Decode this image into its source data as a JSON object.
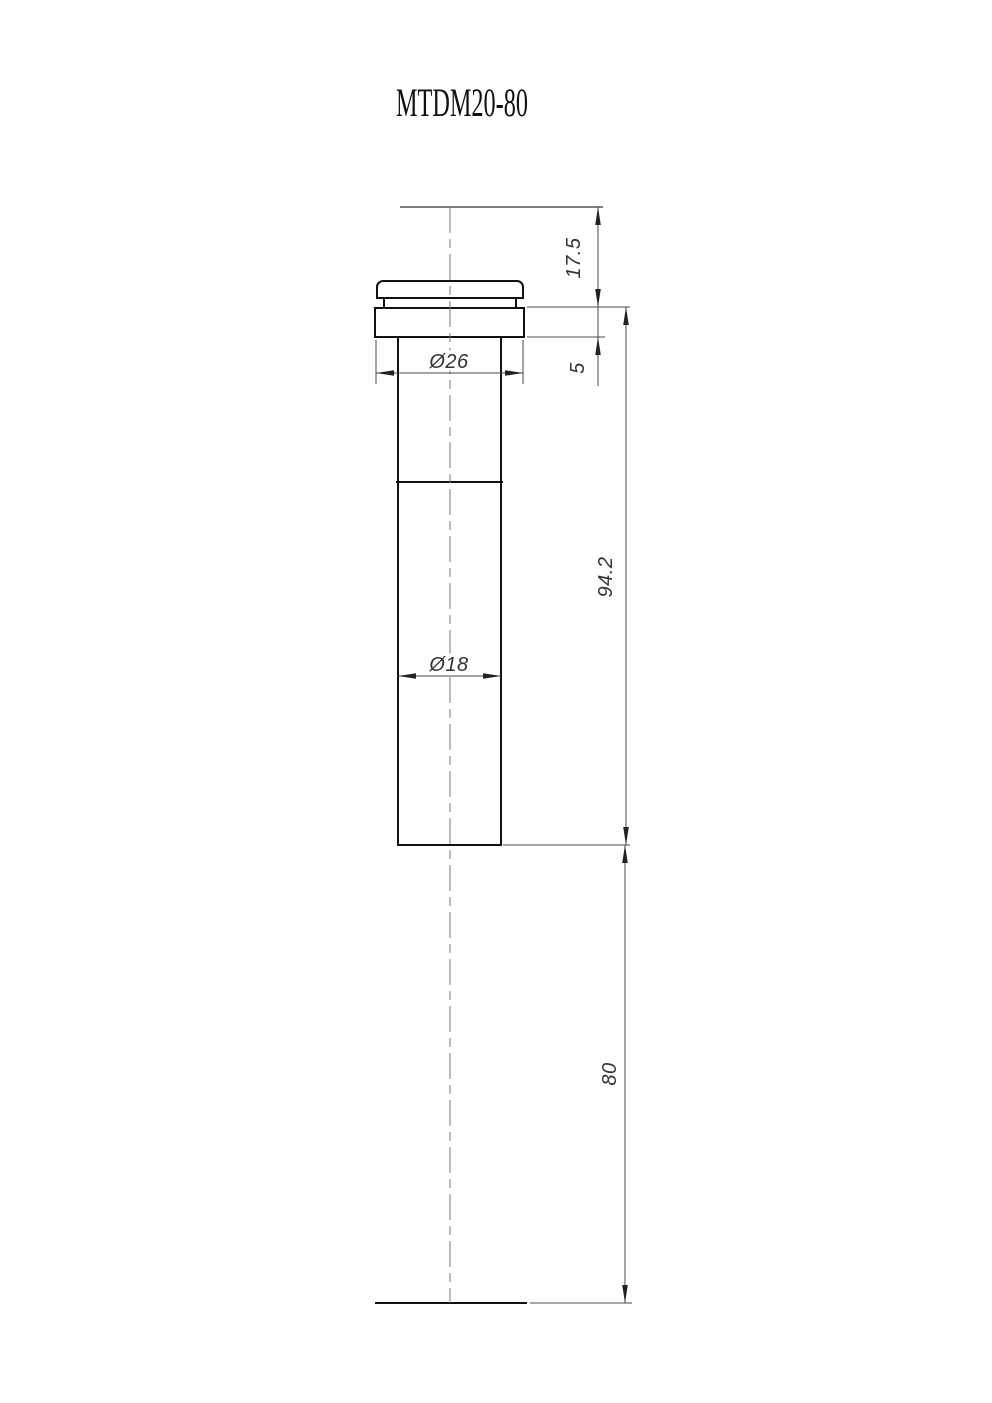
{
  "drawing": {
    "title": "MTDM20-80",
    "dims": {
      "top_offset": "17.5",
      "flange_thickness": "5",
      "body_length": "94.2",
      "lower_length": "80",
      "flange_diameter": "Ø26",
      "barrel_diameter": "Ø18"
    },
    "colors": {
      "object_line": "#111111",
      "dimension_line": "#4a4a4a",
      "center_line": "#7a7a7a",
      "text": "#333333",
      "background": "#ffffff"
    }
  }
}
